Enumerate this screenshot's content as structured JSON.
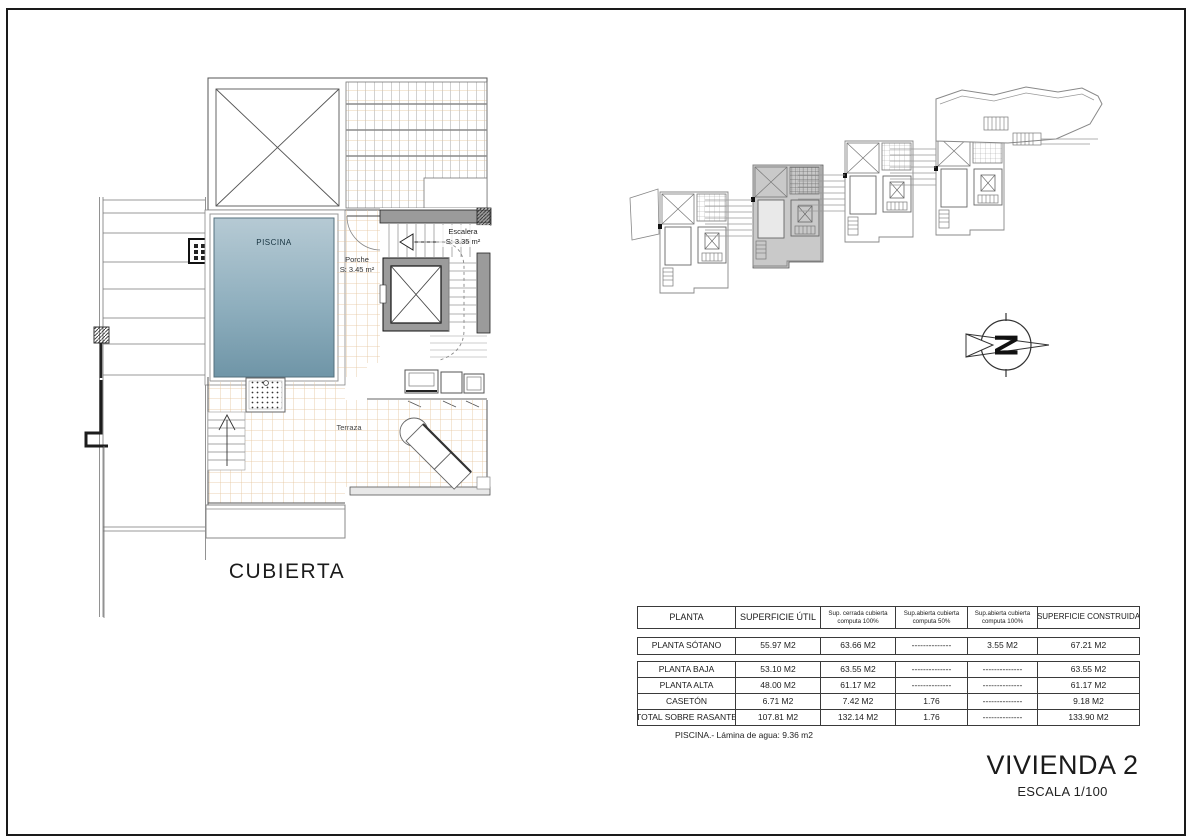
{
  "sheet": {
    "background": "#ffffff",
    "border_color": "#1a1a1a"
  },
  "plan": {
    "title": "CUBIERTA",
    "labels": {
      "piscina": "PISCINA",
      "porche_line1": "Porche",
      "porche_line2": "S: 3.45 m²",
      "escalera_line1": "Escalera",
      "escalera_line2": "S: 3.35 m²",
      "terraza": "Terraza"
    },
    "colors": {
      "pool_top": "#b6cad4",
      "pool_mid": "#8fafbe",
      "pool_bottom": "#6f95a7",
      "tile_line": "#e5c49a",
      "wall_gray": "#9b9b9b",
      "highlight_gray": "#c9c9c9"
    }
  },
  "compass": {
    "letter": "N"
  },
  "areas_table": {
    "headers": [
      {
        "line1": "PLANTA",
        "line2": ""
      },
      {
        "line1": "SUPERFICIE ÚTIL",
        "line2": ""
      },
      {
        "line1": "Sup. cerrada cubierta",
        "line2": "computa 100%"
      },
      {
        "line1": "Sup.abierta cubierta",
        "line2": "computa 50%"
      },
      {
        "line1": "Sup.abierta cubierta",
        "line2": "computa 100%"
      },
      {
        "line1": "SUPERFICIE CONSTRUIDA",
        "line2": ""
      }
    ],
    "sotano": [
      "PLANTA SÓTANO",
      "55.97 M2",
      "63.66 M2",
      "--------------",
      "3.55 M2",
      "67.21 M2"
    ],
    "rows": [
      [
        "PLANTA BAJA",
        "53.10 M2",
        "63.55 M2",
        "--------------",
        "--------------",
        "63.55 M2"
      ],
      [
        "PLANTA ALTA",
        "48.00 M2",
        "61.17 M2",
        "--------------",
        "--------------",
        "61.17 M2"
      ],
      [
        "CASETÓN",
        "6.71 M2",
        "7.42 M2",
        "1.76",
        "--------------",
        "9.18 M2"
      ],
      [
        "TOTAL SOBRE RASANTE",
        "107.81 M2",
        "132.14 M2",
        "1.76",
        "--------------",
        "133.90 M2"
      ]
    ],
    "footer": "PISCINA.- Lámina de agua: 9.36 m2"
  },
  "titleblock": {
    "title": "VIVIENDA 2",
    "scale": "ESCALA 1/100"
  }
}
